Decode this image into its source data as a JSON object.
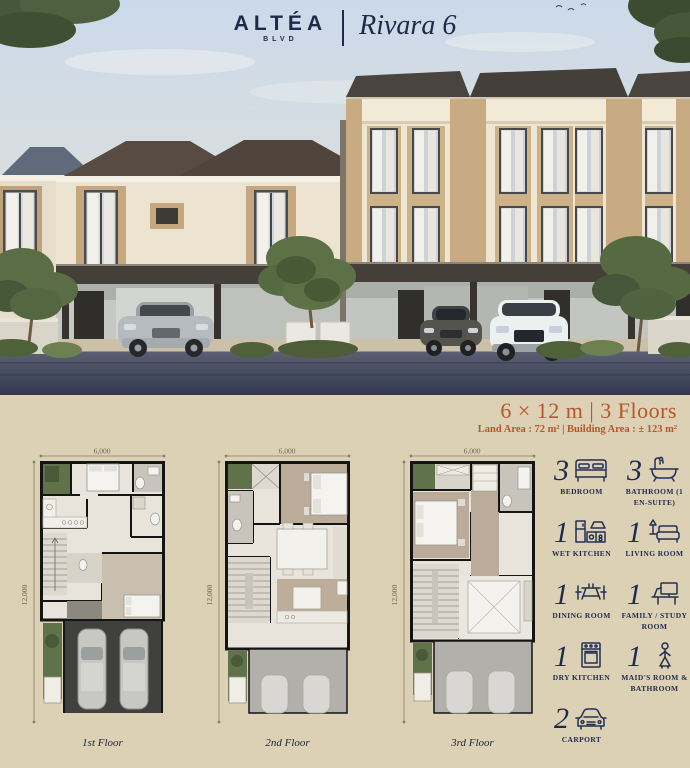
{
  "header": {
    "logo_primary": "ALTÉA",
    "logo_secondary": "BLVD",
    "series_name": "Rivara 6"
  },
  "specs": {
    "headline": "6 × 12 m | 3 Floors",
    "details": "Land Area : 72 m² | Building Area : ± 123 m²"
  },
  "floorplans": {
    "width_label": "6,000",
    "height_label": "12,000",
    "items": [
      {
        "caption": "1st Floor"
      },
      {
        "caption": "2nd Floor"
      },
      {
        "caption": "3rd Floor"
      }
    ]
  },
  "legend": {
    "items": [
      {
        "count": "3",
        "label": "BEDROOM",
        "icon": "bed-icon"
      },
      {
        "count": "3",
        "label": "BATHROOM (1 EN-SUITE)",
        "icon": "bathtub-icon"
      },
      {
        "count": "1",
        "label": "WET KITCHEN",
        "icon": "kitchen-icon"
      },
      {
        "count": "1",
        "label": "LIVING ROOM",
        "icon": "sofa-icon"
      },
      {
        "count": "1",
        "label": "DINING ROOM",
        "icon": "dining-table-icon"
      },
      {
        "count": "1",
        "label": "FAMILY / STUDY ROOM",
        "icon": "desk-icon"
      },
      {
        "count": "1",
        "label": "DRY KITCHEN",
        "icon": "oven-icon"
      },
      {
        "count": "1",
        "label": "MAID'S ROOM & BATHROOM",
        "icon": "maid-icon"
      },
      {
        "count": "2",
        "label": "CARPORT",
        "icon": "car-icon"
      }
    ]
  },
  "colors": {
    "accent_orange": "#b5572b",
    "navy": "#1f2b4c",
    "background_beige": "#dcd0b5"
  }
}
